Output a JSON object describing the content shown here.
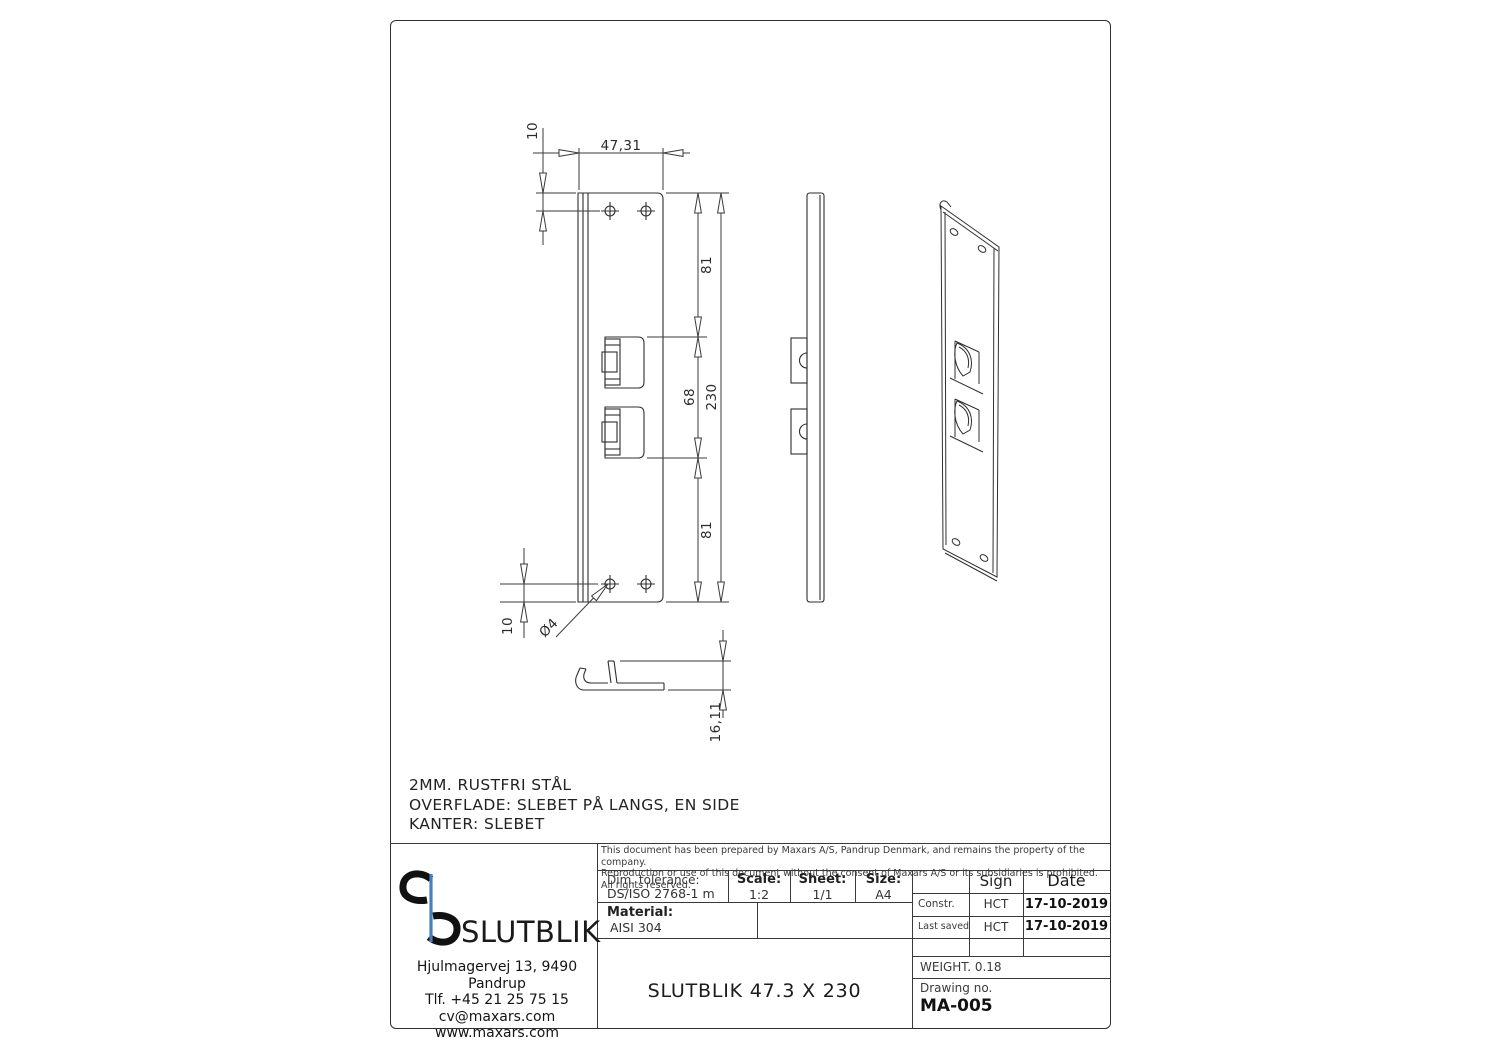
{
  "sheet": {
    "notes": [
      "2MM. RUSTFRI STÅL",
      "OVERFLADE: SLEBET PÅ LANGS, EN SIDE",
      "KANTER: SLEBET"
    ]
  },
  "dimensions": {
    "hole_offset_top": "10",
    "plate_width": "47,31",
    "section_top": "81",
    "section_middle": "68",
    "overall_height": "230",
    "section_bottom": "81",
    "hole_offset_bottom": "10",
    "hole_diameter": "Ø4",
    "flange_height": "16,11"
  },
  "title_block": {
    "disclaimer": [
      "This document has been prepared by Maxars A/S, Pandrup Denmark, and remains the property of the company.",
      "Reproduction or use of this document without the consent of Maxars A/S or its subsidiaries is prohibited. All rights reserved."
    ],
    "dim_tolerance_label": "Dim. tolerance:",
    "dim_tolerance_value": "DS/ISO 2768-1 m",
    "scale_label": "Scale:",
    "scale_value": "1:2",
    "sheet_label": "Sheet:",
    "sheet_value": "1/1",
    "size_label": "Size:",
    "size_value": "A4",
    "material_label": "Material:",
    "material_value": "AISI 304",
    "part_title": "SLUTBLIK 47.3 X 230",
    "sign_header": "Sign",
    "date_header": "Date",
    "constr_label": "Constr.",
    "constr_sign": "HCT",
    "constr_date": "17-10-2019",
    "last_saved_label": "Last saved",
    "last_saved_sign": "HCT",
    "last_saved_date": "17-10-2019",
    "weight": "WEIGHT. 0.18",
    "drawing_no_label": "Drawing no.",
    "drawing_no_value": "MA-005"
  },
  "company": {
    "logo_text": "SLUTBLIK",
    "address": "Hjulmagervej 13, 9490 Pandrup",
    "phone": "Tlf. +45 21 25 75 15",
    "email": "cv@maxars.com",
    "website": "www.maxars.com"
  },
  "colors": {
    "line": "#2f2f2f",
    "dimension_line": "#3a3a3a",
    "logo_blue": "#4a7ebf"
  }
}
